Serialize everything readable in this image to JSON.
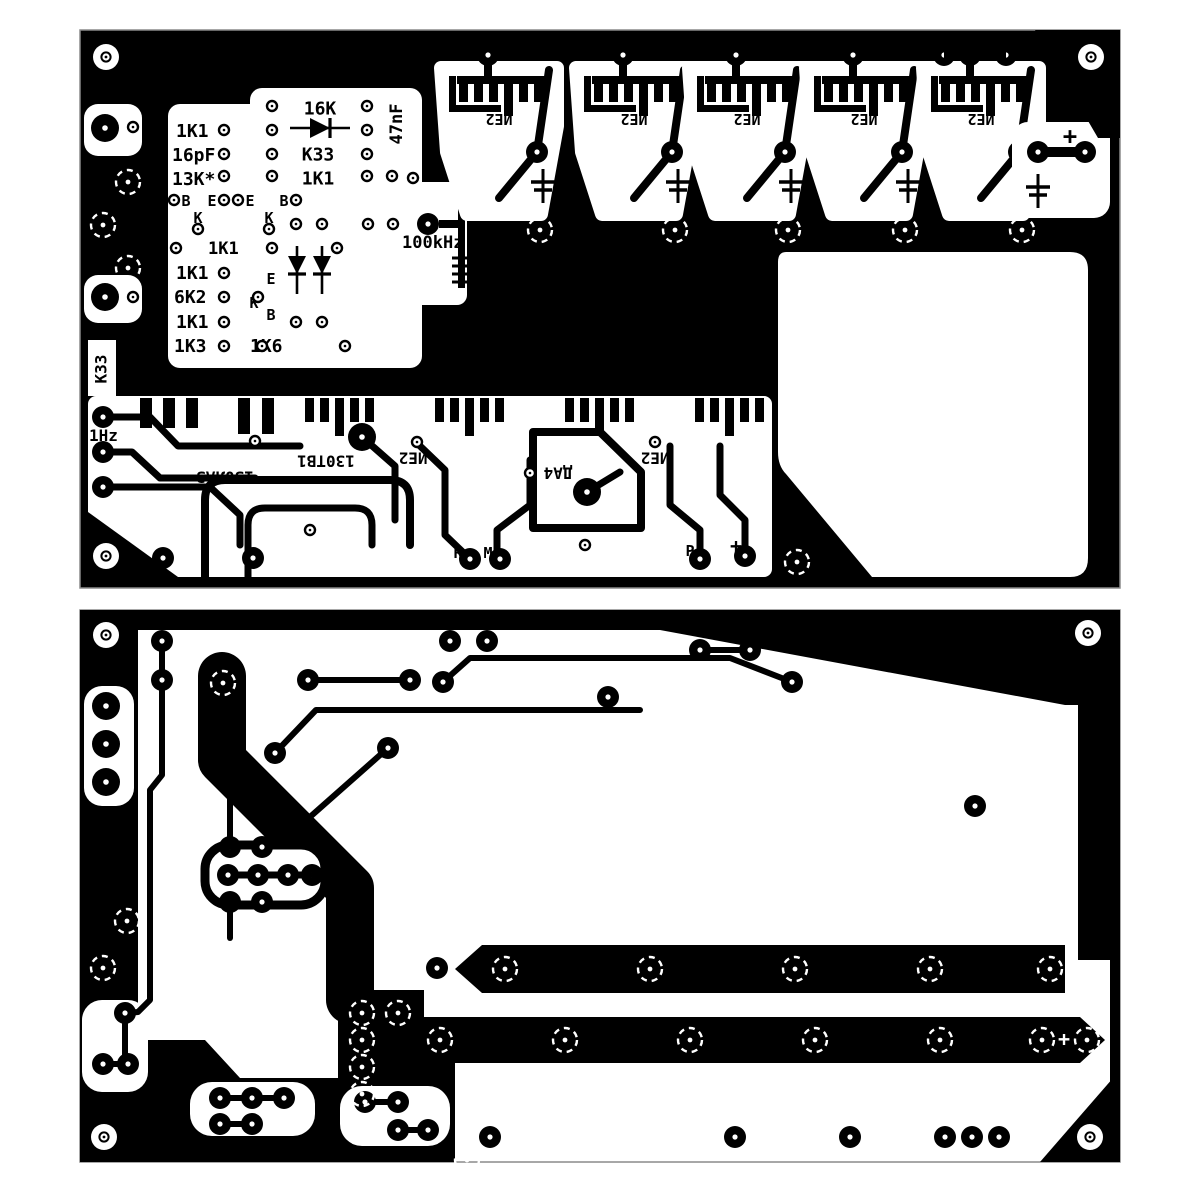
{
  "title": "PCB layout — frequency divider board, top and bottom copper sides",
  "colors": {
    "copper": "#000000",
    "board": "#ffffff",
    "edge": "#8a8a8a"
  },
  "top_board": {
    "left_panel": {
      "res1": "1K1",
      "cap1": "16pF",
      "res2": "13K*",
      "res3": "16K",
      "res4": "K33",
      "res5": "1K1",
      "cap2": "47nF",
      "pin_b1": "B",
      "pin_e1": "E",
      "pin_e2": "E",
      "pin_b2": "B",
      "pin_k1": "K",
      "pin_k2": "K",
      "res6": "1K1",
      "res7": "1K1",
      "res8": "6K2",
      "pin_k3": "K",
      "pin_e3": "E",
      "pin_b3": "B",
      "res9": "1K1",
      "res10": "1K3",
      "res11": "1K6"
    },
    "clock_label": "100kHz",
    "freq": {
      "u1": "10KHz",
      "u3": "100Hz",
      "u4": "10Hz",
      "u5": "1Hz"
    },
    "ic_label": "ИЕ2",
    "plus_label": "+",
    "left_edge": {
      "cap": "K33",
      "freq": "1Hz"
    },
    "middle_band": {
      "freq": "1Hz",
      "ics": [
        "130ЛА3",
        "130ТВ1",
        "ИЕ2",
        "ДА4",
        "ИЕ2"
      ],
      "pad_r": "R",
      "pad_m": "M",
      "pad_p": "P",
      "plus": "+"
    }
  },
  "bottom_board": {
    "plus": "+"
  }
}
